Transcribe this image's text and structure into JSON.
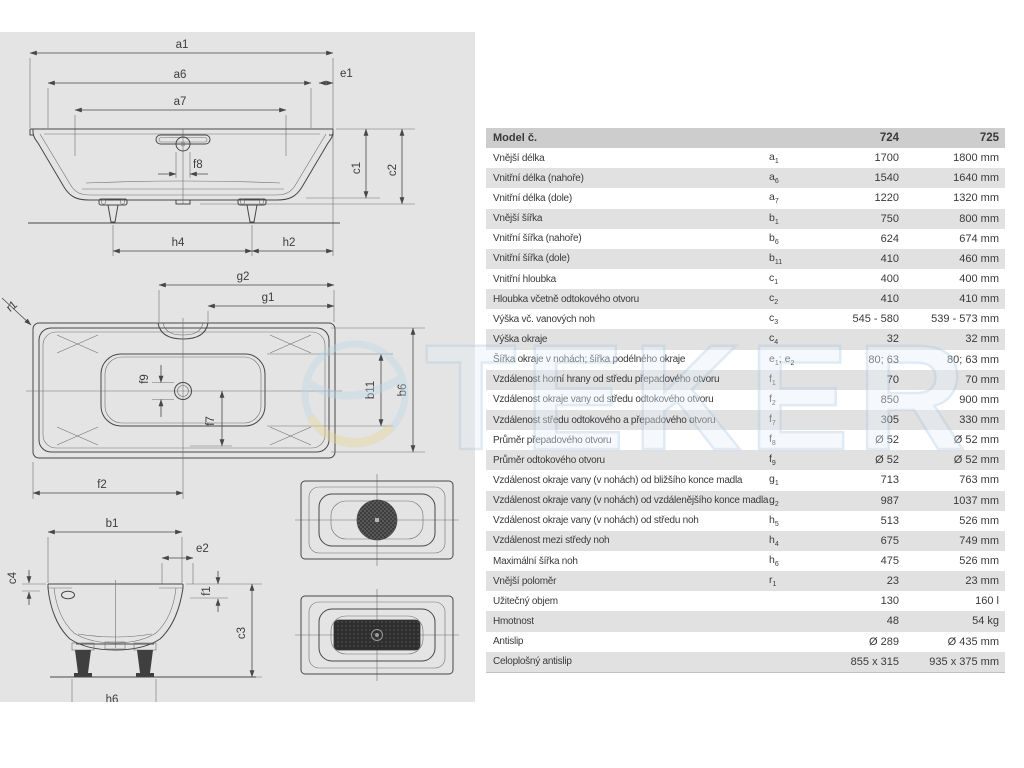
{
  "watermark": {
    "text": "TEKER"
  },
  "drawings": {
    "elevation": {
      "a1": "a1",
      "a6": "a6",
      "a7": "a7",
      "e1": "e1",
      "f8": "f8",
      "c1": "c1",
      "c2": "c2",
      "h4": "h4",
      "h2": "h2"
    },
    "plan": {
      "g2": "g2",
      "g1": "g1",
      "r1": "r1",
      "f9": "f9",
      "f7": "f7",
      "f2": "f2",
      "b11": "b11",
      "b6": "b6"
    },
    "section": {
      "b1": "b1",
      "e2": "e2",
      "c4": "c4",
      "f1": "f1",
      "c3": "c3",
      "h6": "h6"
    }
  },
  "table": {
    "header": {
      "model_label": "Model č.",
      "col_724": "724",
      "col_725": "725"
    },
    "rows": [
      {
        "label": "Vnější délka",
        "sym": "a",
        "sub": "1",
        "v1": "1700",
        "v2": "1800 mm"
      },
      {
        "label": "Vnitřní délka (nahoře)",
        "sym": "a",
        "sub": "6",
        "v1": "1540",
        "v2": "1640 mm"
      },
      {
        "label": "Vnitřní délka (dole)",
        "sym": "a",
        "sub": "7",
        "v1": "1220",
        "v2": "1320 mm"
      },
      {
        "label": "Vnější šířka",
        "sym": "b",
        "sub": "1",
        "v1": "750",
        "v2": "800 mm"
      },
      {
        "label": "Vnitřní šířka (nahoře)",
        "sym": "b",
        "sub": "6",
        "v1": "624",
        "v2": "674 mm"
      },
      {
        "label": "Vnitřní šířka (dole)",
        "sym": "b",
        "sub": "11",
        "v1": "410",
        "v2": "460 mm"
      },
      {
        "label": "Vnitřní hloubka",
        "sym": "c",
        "sub": "1",
        "v1": "400",
        "v2": "400 mm"
      },
      {
        "label": "Hloubka včetně odtokového otvoru",
        "sym": "c",
        "sub": "2",
        "v1": "410",
        "v2": "410 mm"
      },
      {
        "label": "Výška vč. vanových noh",
        "sym": "c",
        "sub": "3",
        "v1": "545 - 580",
        "v2": "539 - 573 mm"
      },
      {
        "label": "Výška okraje",
        "sym": "c",
        "sub": "4",
        "v1": "32",
        "v2": "32 mm"
      },
      {
        "label": "Šířka okraje v nohách; šířka podélného okraje",
        "sym": "e",
        "sub": "1",
        "sym2": "e",
        "sub2": "2",
        "v1": "80; 63",
        "v2": "80; 63 mm"
      },
      {
        "label": "Vzdálenost horní hrany od středu přepadového otvoru",
        "sym": "f",
        "sub": "1",
        "v1": "70",
        "v2": "70 mm"
      },
      {
        "label": "Vzdálenost okraje vany od středu odtokového otvoru",
        "sym": "f",
        "sub": "2",
        "v1": "850",
        "v2": "900 mm"
      },
      {
        "label": "Vzdálenost středu odtokového a přepadového otvoru",
        "sym": "f",
        "sub": "7",
        "v1": "305",
        "v2": "330 mm"
      },
      {
        "label": "Průměr přepadového otvoru",
        "sym": "f",
        "sub": "8",
        "v1": "Ø 52",
        "v2": "Ø 52 mm"
      },
      {
        "label": "Průměr odtokového otvoru",
        "sym": "f",
        "sub": "9",
        "v1": "Ø 52",
        "v2": "Ø 52 mm"
      },
      {
        "label": "Vzdálenost okraje vany (v nohách) od bližšího konce madla",
        "sym": "g",
        "sub": "1",
        "v1": "713",
        "v2": "763 mm"
      },
      {
        "label": "Vzdálenost okraje vany (v nohách) od vzdálenějšího konce madla",
        "sym": "g",
        "sub": "2",
        "v1": "987",
        "v2": "1037 mm"
      },
      {
        "label": "Vzdálenost okraje vany (v nohách) od středu noh",
        "sym": "h",
        "sub": "5",
        "v1": "513",
        "v2": "526 mm"
      },
      {
        "label": "Vzdálenost mezi středy noh",
        "sym": "h",
        "sub": "4",
        "v1": "675",
        "v2": "749 mm"
      },
      {
        "label": "Maximální šířka noh",
        "sym": "h",
        "sub": "6",
        "v1": "475",
        "v2": "526 mm"
      },
      {
        "label": "Vnější poloměr",
        "sym": "r",
        "sub": "1",
        "v1": "23",
        "v2": "23 mm"
      },
      {
        "label": "Užitečný objem",
        "sym": "",
        "sub": "",
        "v1": "130",
        "v2": "160 l"
      },
      {
        "label": "Hmotnost",
        "sym": "",
        "sub": "",
        "v1": "48",
        "v2": "54 kg"
      },
      {
        "label": "Antislip",
        "sym": "",
        "sub": "",
        "v1": "Ø 289",
        "v2": "Ø 435 mm"
      },
      {
        "label": "Celoplošný antislip",
        "sym": "",
        "sub": "",
        "v1": "855 x 315",
        "v2": "935 x 375 mm"
      }
    ]
  }
}
